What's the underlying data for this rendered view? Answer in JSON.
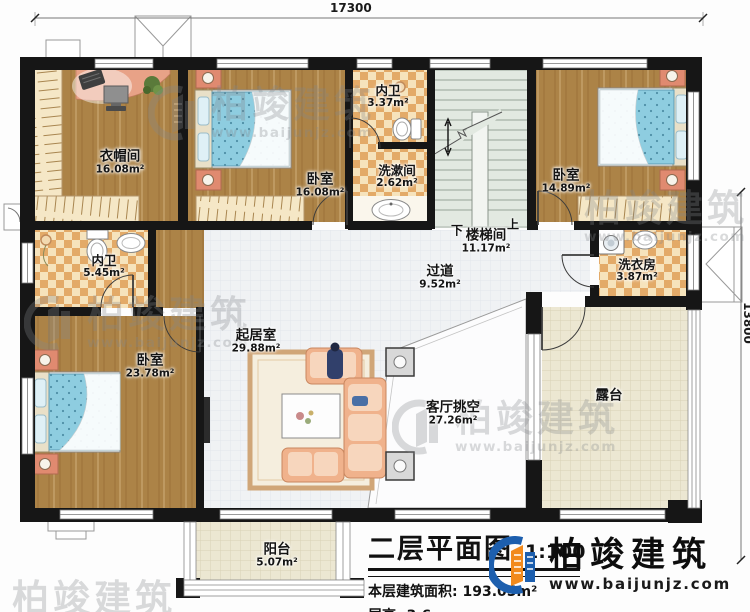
{
  "plan": {
    "dimensions": {
      "width_mm": "17300",
      "height_mm": "13800"
    },
    "rooms": {
      "cloakroom": {
        "name": "衣帽间",
        "area": "16.08m²"
      },
      "bedroom_top": {
        "name": "卧室",
        "area": "16.08m²"
      },
      "bath_top": {
        "name": "内卫",
        "area": "3.37m²"
      },
      "washroom": {
        "name": "洗漱间",
        "area": "2.62m²"
      },
      "stairwell": {
        "name": "楼梯间",
        "area": "11.17m²",
        "down": "下",
        "up": "上"
      },
      "bedroom_right": {
        "name": "卧室",
        "area": "14.89m²"
      },
      "laundry": {
        "name": "洗衣房",
        "area": "3.87m²"
      },
      "bath_left": {
        "name": "内卫",
        "area": "5.45m²"
      },
      "corridor": {
        "name": "过道",
        "area": "9.52m²"
      },
      "living": {
        "name": "起居室",
        "area": "29.88m²"
      },
      "bedroom_bottom": {
        "name": "卧室",
        "area": "23.78m²"
      },
      "void": {
        "name": "客厅挑空",
        "area": "27.26m²"
      },
      "terrace": {
        "name": "露台"
      },
      "balcony": {
        "name": "阳台",
        "area": "5.07m²"
      }
    }
  },
  "title_block": {
    "title": "二层平面图",
    "scale": "1:100",
    "floor_area_label": "本层建筑面积:",
    "floor_area_value": "193.05m²",
    "floor_height_label": "层高:",
    "floor_height_value": "3.6m"
  },
  "brand": {
    "name": "柏竣建筑",
    "website": "www.baijunjz.com"
  },
  "watermark": {
    "name": "柏竣建筑",
    "website": "www.baijunjz.com"
  },
  "colors": {
    "wall": "#161616",
    "wood_floor": "#ac8347",
    "tile_light": "#f6e3bc",
    "tile_dark": "#e3aa68",
    "bed": "#8ecde0",
    "stair_floor": "#e2e9e1",
    "terrace_floor": "#ece7d2",
    "living_floor": "#f0f2f4",
    "logo_blue": "#1d5fae",
    "logo_orange": "#f28a1c"
  }
}
